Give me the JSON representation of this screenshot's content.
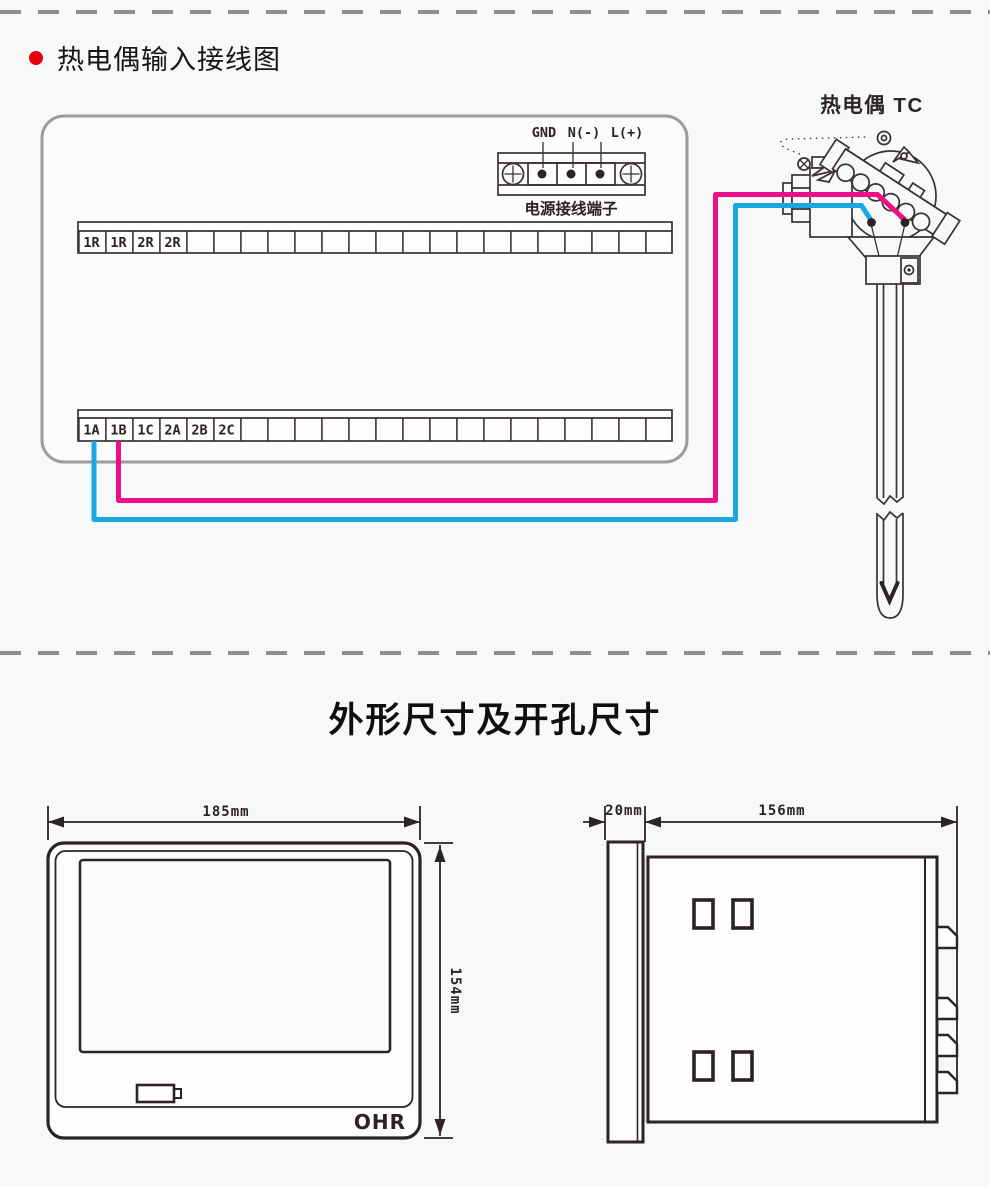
{
  "page": {
    "background": "#f7f8f8",
    "dash_color": "#8f8f8f"
  },
  "wiring_section": {
    "title": "热电偶输入接线图",
    "bullet_color": "#e60012",
    "power_terminal": {
      "labels": [
        "GND",
        "N(-)",
        "L(+)"
      ],
      "caption": "电源接线端子"
    },
    "top_terminal_labels": [
      "1R",
      "1R",
      "2R",
      "2R"
    ],
    "bottom_terminal_labels": [
      "1A",
      "1B",
      "1C",
      "2A",
      "2B",
      "2C"
    ],
    "thermocouple_label": "热电偶 TC",
    "wires": {
      "magenta": "#ec0f87",
      "cyan": "#1da7e2"
    }
  },
  "dimensions_section": {
    "title": "外形尺寸及开孔尺寸",
    "front_view": {
      "width": "185mm",
      "height": "154mm",
      "logo": "OHR"
    },
    "side_view": {
      "bezel_depth": "20mm",
      "body_depth": "156mm"
    }
  }
}
